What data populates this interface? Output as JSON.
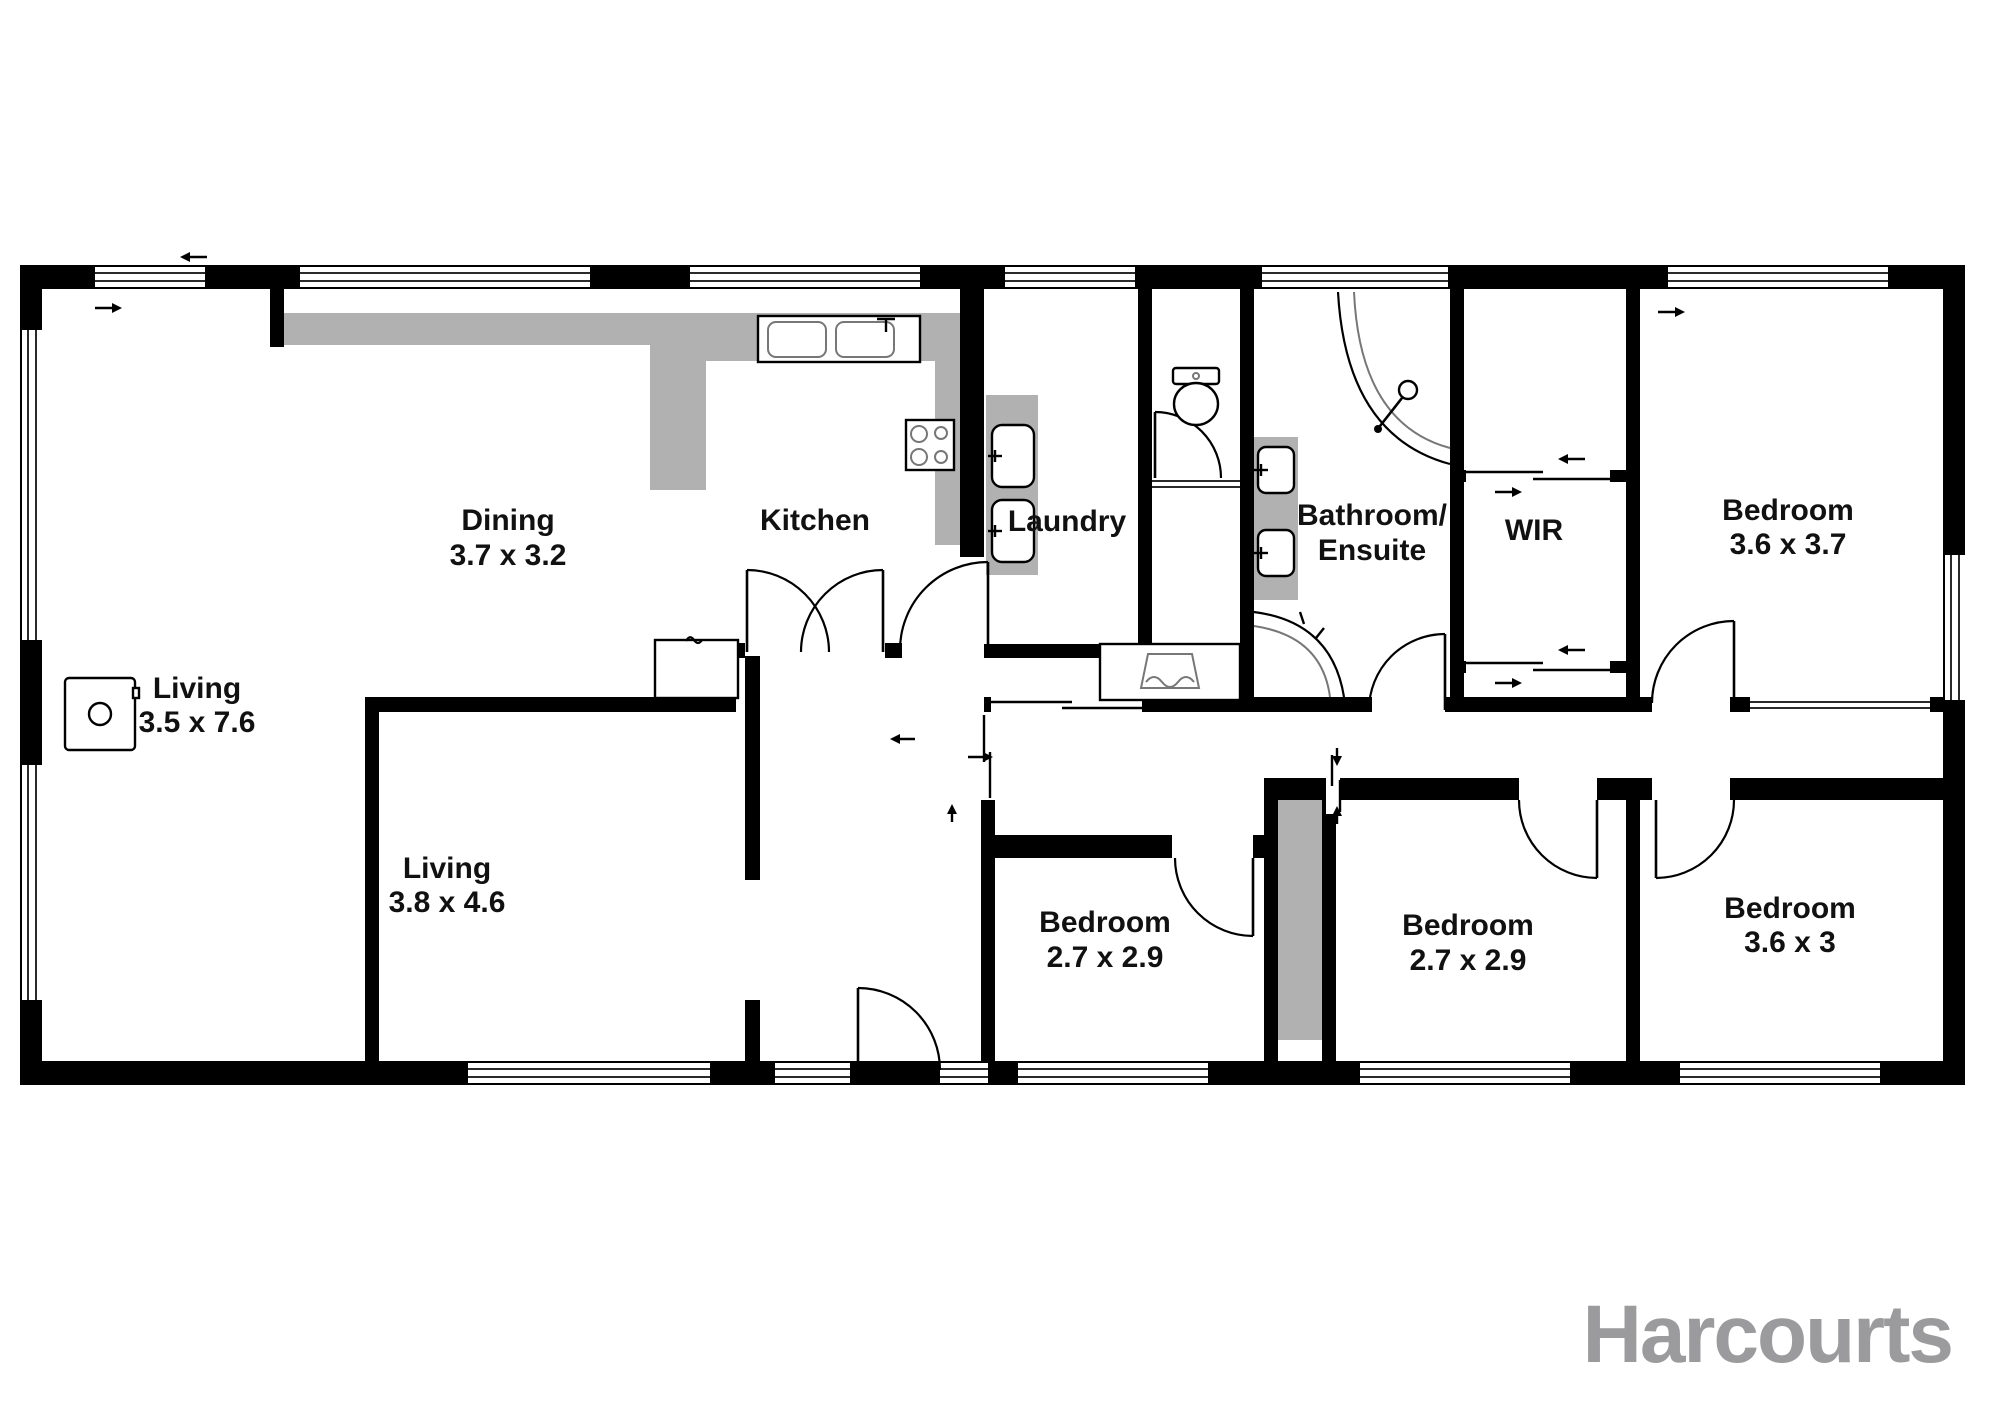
{
  "branding": {
    "logo_text": "Harcourts",
    "logo_color": "#9b9b9d"
  },
  "colors": {
    "wall": "#000000",
    "bench_gray": "#b1b1b1",
    "label": "#111111",
    "background": "#ffffff"
  },
  "rooms": {
    "living_main": {
      "name": "Living",
      "dims": "3.5 x 7.6"
    },
    "dining": {
      "name": "Dining",
      "dims": "3.7 x 3.2"
    },
    "kitchen": {
      "name": "Kitchen"
    },
    "laundry": {
      "name": "Laundry"
    },
    "bathroom_ensuite": {
      "name": "Bathroom/",
      "name_line2": "Ensuite"
    },
    "wir": {
      "name": "WIR"
    },
    "bedroom_top_right": {
      "name": "Bedroom",
      "dims": "3.6 x 3.7"
    },
    "living_second": {
      "name": "Living",
      "dims": "3.8 x 4.6"
    },
    "bedroom_bottom_left": {
      "name": "Bedroom",
      "dims": "2.7 x 2.9"
    },
    "bedroom_bottom_middle": {
      "name": "Bedroom",
      "dims": "2.7 x 2.9"
    },
    "bedroom_bottom_right": {
      "name": "Bedroom",
      "dims": "3.6 x 3"
    }
  }
}
